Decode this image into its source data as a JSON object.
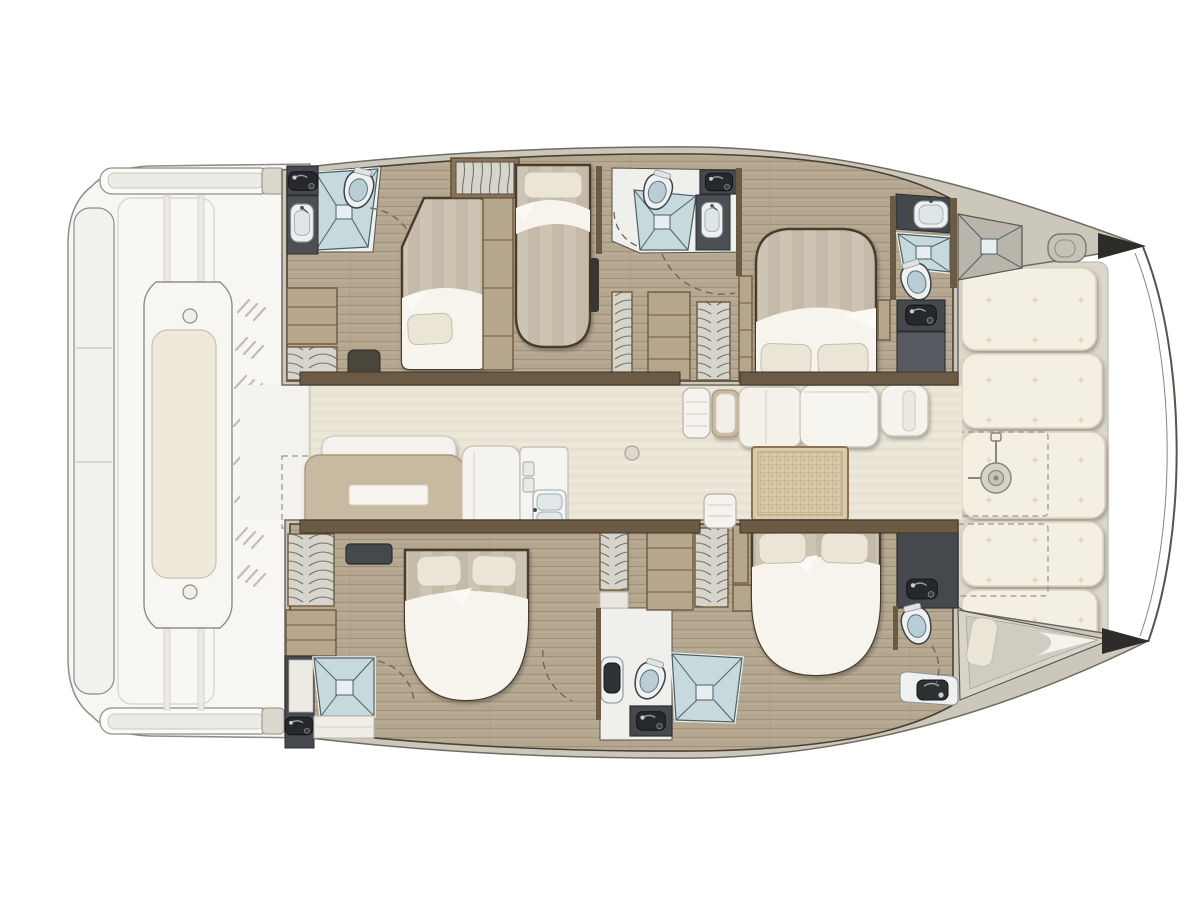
{
  "vessel": {
    "description": "Top-down interior deck plan of a sailing catamaran, bow pointing right",
    "type": "sailing-catamaran",
    "view": "overhead floor plan",
    "orientation": {
      "bow": "right",
      "stern": "left",
      "port_hull": "top",
      "starboard_hull": "bottom"
    }
  },
  "colors": {
    "background": "#ffffff",
    "deck_white": "#f7f6f3",
    "hull_rim_greige": "#cbc7bb",
    "bow_deck": "#b5b1a6",
    "cabin_floor_teak": "#b5a78f",
    "wood_cabinet": "#b6a68c",
    "wall_brown": "#6b5a44",
    "wardrobe_charcoal": "#45494e",
    "fixture_black": "#26282c",
    "mattress_beige": "#cec4b3",
    "sheet_white": "#f6f4ec",
    "pillow_cream": "#ebe5d7",
    "shower_blue": "#c6dade",
    "bathroom_floor": "#eff0ec",
    "toilet_lid_blue": "#b9cdd4",
    "saloon_floor_cream": "#eae5d7",
    "sofa_tan": "#c8b9a1",
    "rattan_table": "#d9c9aa",
    "sunpad_cream": "#f3efe3",
    "bow_tip_black": "#2e2c28"
  },
  "areas": {
    "aft_deck": {
      "features": [
        "swim-platform-steps-top",
        "swim-platform-steps-bottom",
        "side-platform",
        "cockpit-bench-with-cushion",
        "louver-vents"
      ]
    },
    "saloon": {
      "features": [
        "sofa-with-table",
        "settee",
        "galley-counter",
        "galley-double-sink",
        "stove",
        "dinette-table",
        "dinette-seating",
        "chaise-seat",
        "rattan-low-table",
        "mast-post"
      ]
    },
    "port_hull": {
      "rooms": [
        "aft-heads (toilet, shower, vanity sink)",
        "aft-double-cabin",
        "single-berth-cabin",
        "mid-heads (toilet, shower, vanity sink)",
        "forward-double-cabin",
        "forward-heads (toilet, shower, vanity sink)",
        "forepeak-locker"
      ],
      "storage": [
        "wardrobe",
        "hanging-locker",
        "shelf-units",
        "spring-lockers"
      ]
    },
    "starboard_hull": {
      "rooms": [
        "aft-double-cabin",
        "aft-shower-room",
        "mid-heads (toilet, shower, vanity sink)",
        "forward-double-cabin",
        "forward-heads (toilet, vanity sink)",
        "forepeak-berth"
      ],
      "storage": [
        "wardrobe",
        "shelf-units",
        "spring-lockers"
      ]
    },
    "foredeck": {
      "features": [
        "sunpad-cushions",
        "deck-locker-dashed-outlines",
        "windlass",
        "anchor-pod",
        "bowsprit-lines"
      ]
    }
  },
  "counts": {
    "double_beds": 4,
    "single_beds": 1,
    "forepeak_berths": 1,
    "toilets": 5,
    "showers": 5,
    "sinks": 8,
    "sunpad_cushions": 5
  }
}
